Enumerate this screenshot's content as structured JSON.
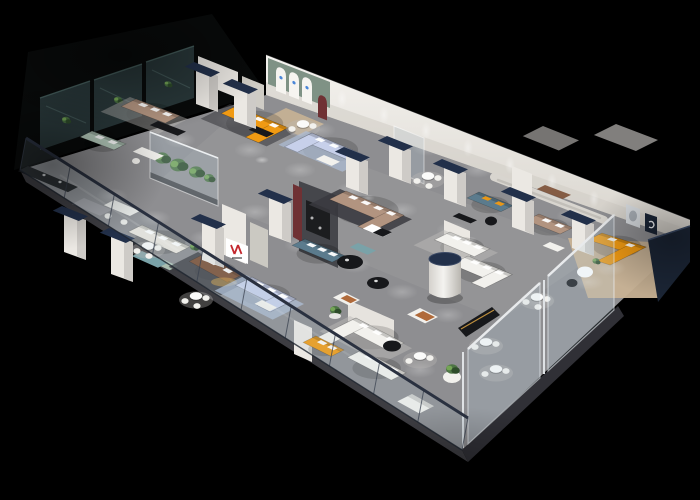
{
  "scene": {
    "type": "3d-isometric-floorplan-render",
    "subject": "furniture showroom interior cutaway viewed from above",
    "background": "#000000",
    "orientation": "long slab running from lower-left corner to upper-right, front edge lined with glass balustrade"
  },
  "palette": {
    "bg": "#000000",
    "floor": "#8e8e91",
    "floorHi": "#a7a6a9",
    "slabSide": "#3d3d42",
    "slabSide2": "#303036",
    "officeDark": "#080a0a",
    "wall": "#ebe8e3",
    "wallShade": "#cfccc5",
    "wallTop": "#f6f4f0",
    "archWall": "#7f9285",
    "navy": "#22304a",
    "navyDark": "#1b2535",
    "glassOffice": "#2c3b3e",
    "glassHi": "#4e6a68",
    "orange": "#f09a13",
    "periwinkle": "#c7d0ea",
    "tan": "#b29480",
    "sage": "#b6ccbd",
    "teal": "#5b7b8d",
    "tealLight": "#7aa2a8",
    "brown": "#7c5036",
    "cream": "#eae6dd",
    "whiteSofa": "#f2f1ed",
    "gray": "#a3a2a6",
    "rugBlue": "#aebdd6",
    "rugDark": "#3a3a3f",
    "rugLight": "#bcbab7",
    "wood": "#c8b295",
    "charcoal": "#45464b",
    "maroon": "#6f3134",
    "black": "#17181b",
    "green": "#4a7340",
    "greenDark": "#2e4c2a",
    "greenHi": "#79ab58",
    "red": "#c3282e",
    "gold": "#daa343",
    "rust": "#b06a3a",
    "white": "#ffffff",
    "frameLight": "#d6dade",
    "railGlass": "rgba(175,200,215,0.15)",
    "glassTint": "rgba(185,208,222,0.22)"
  },
  "notable_items": [
    "dark tinted-glass meeting rooms along back-left edge",
    "orange L-shaped display sofas (back-center room, far-right room, front-center)",
    "periwinkle blue sectional sofas on blue rugs",
    "tan and brown leather sofas with black coffee tables",
    "sage green sofa and cream sofa vignettes",
    "teal sofas with orange accent pillows",
    "white sofa and bed displays on light rugs",
    "round white dining tables with chairs",
    "planted glass terrarium wall",
    "charcoal media feature wall with maroon arched accent",
    "white cylindrical column with dark navy cap",
    "white display piers capped in dark navy",
    "arched wall niches with small blue logo marks",
    "racetrack routed molding on long back wall",
    "two framed artworks in right room",
    "red-and-black brand mark on white reception panel",
    "full-length glass balustrade along front edge with dark top rail"
  ]
}
